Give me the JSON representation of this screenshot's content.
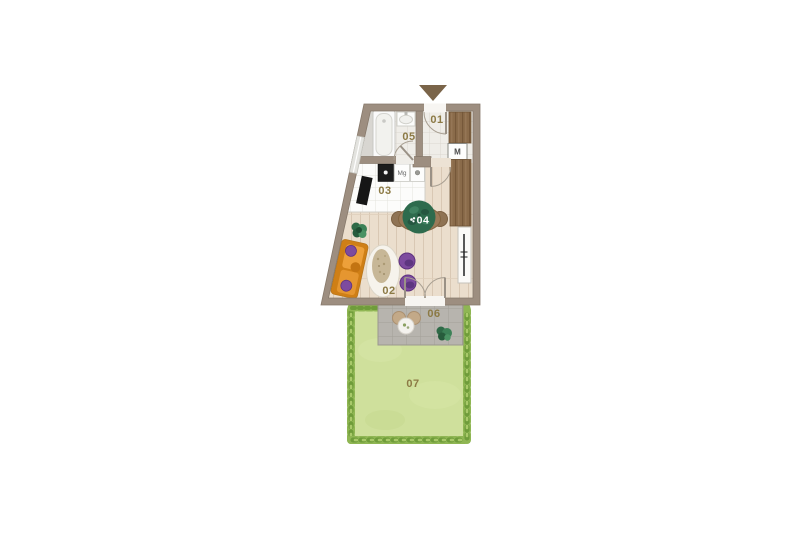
{
  "plan": {
    "type": "apartment-floor-plan",
    "icons": {
      "north_marker": "triangle-down",
      "table_plant": "leaf-icon"
    },
    "rooms": [
      {
        "number": "01"
      },
      {
        "number": "02"
      },
      {
        "number": "03"
      },
      {
        "number": "04"
      },
      {
        "number": "05"
      },
      {
        "number": "06"
      },
      {
        "number": "07"
      }
    ],
    "badges": {
      "meter": "M",
      "kitchen_appliance": "Mg"
    },
    "colors": {
      "background": "#ffffff",
      "wall": "#9d8e80",
      "floor_wood": "#ebdecd",
      "tile_floor": "#efede8",
      "kitchen_counter": "#fcfcfb",
      "terrace": "#b7b4ae",
      "garden": "#cfe09c",
      "hedge": "#7fae4e",
      "wardrobe_wood": "#8a6b4a",
      "sofa": "#e09126",
      "pillow_pouf": "#7d4b9e",
      "plant": "#2e6b4d",
      "rug": "#f6f3ec",
      "label_text": "#8c7a45",
      "north_marker": "#7a6449",
      "cooktop": "#1c1c1c"
    }
  }
}
